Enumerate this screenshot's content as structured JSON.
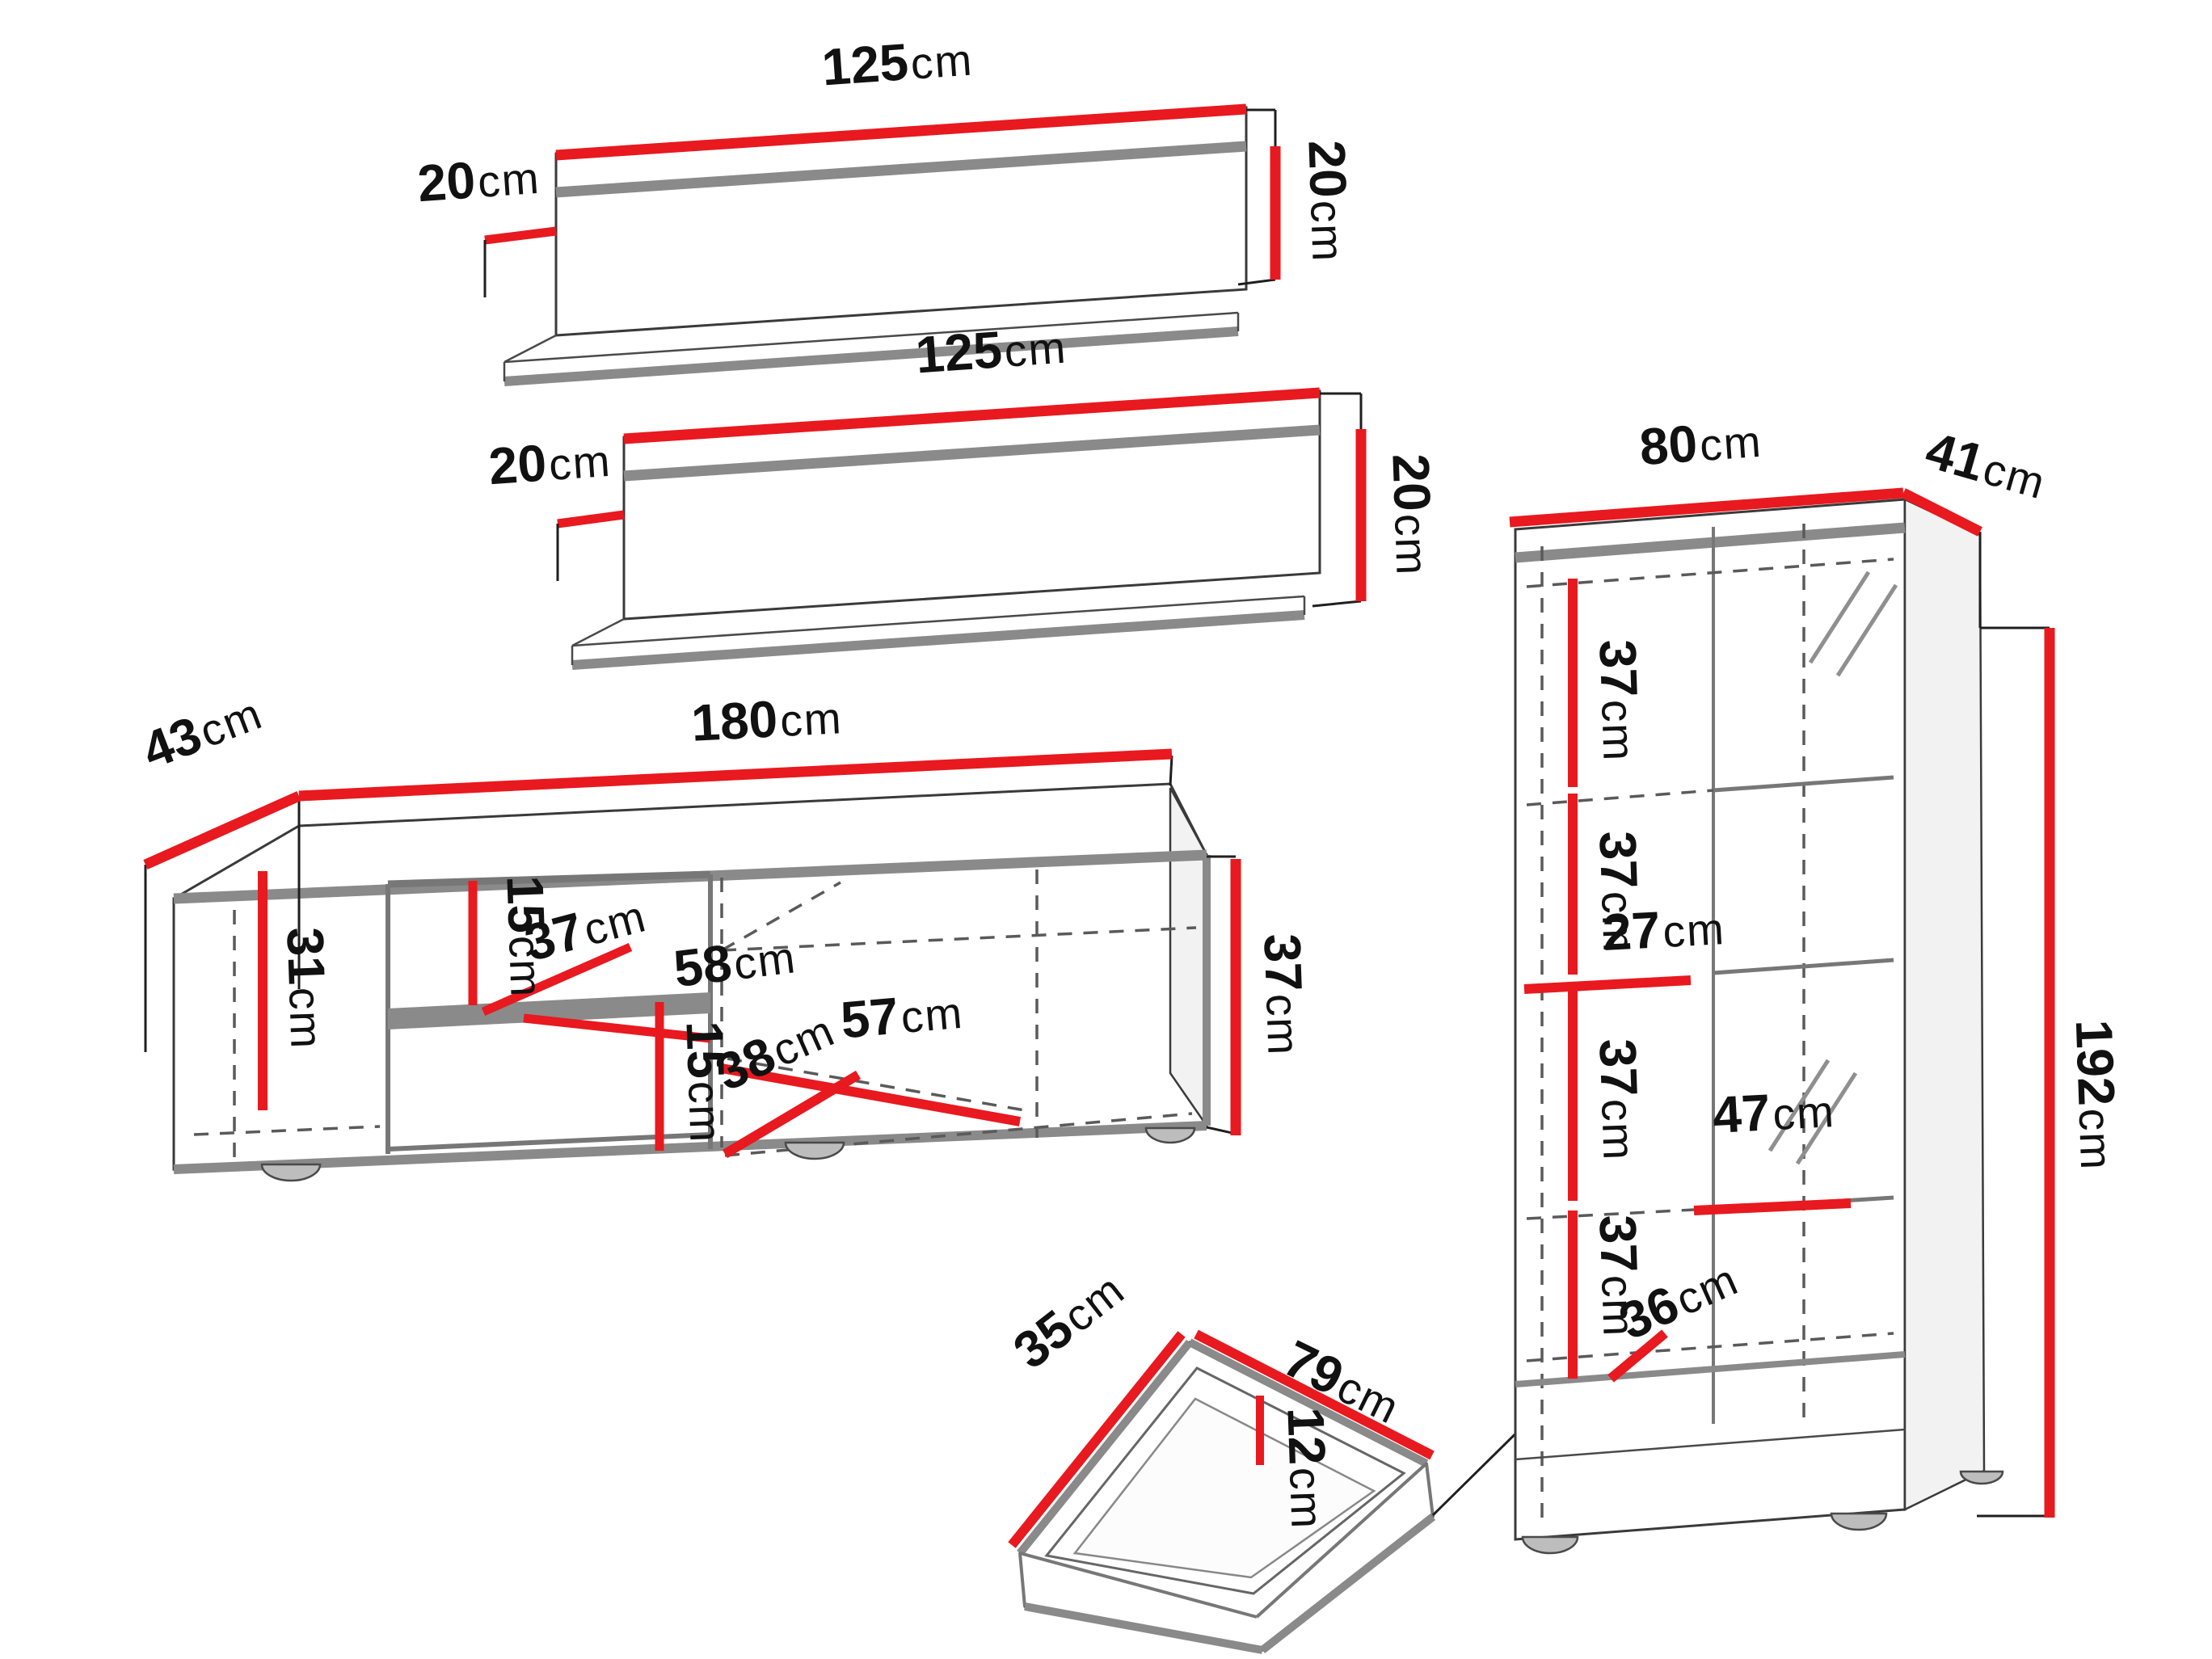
{
  "diagram": {
    "title": "Wall unit furniture set dimensions",
    "unit": "cm",
    "colors": {
      "dimension_red": "#e8191f",
      "outline_gray": "#8a8a8a",
      "line_black": "#1f1f1f"
    },
    "wall_shelf_1": {
      "width": {
        "num": "125",
        "unit": "cm"
      },
      "depth": {
        "num": "20",
        "unit": "cm"
      },
      "height": {
        "num": "20",
        "unit": "cm"
      }
    },
    "wall_shelf_2": {
      "width": {
        "num": "125",
        "unit": "cm"
      },
      "depth": {
        "num": "20",
        "unit": "cm"
      },
      "height": {
        "num": "20",
        "unit": "cm"
      }
    },
    "tv_stand": {
      "depth": {
        "num": "43",
        "unit": "cm"
      },
      "width": {
        "num": "180",
        "unit": "cm"
      },
      "left_inner_height": {
        "num": "31",
        "unit": "cm"
      },
      "upper_niche_height": {
        "num": "15",
        "unit": "cm"
      },
      "shelf_depth": {
        "num": "37",
        "unit": "cm"
      },
      "middle_width": {
        "num": "58",
        "unit": "cm"
      },
      "lower_niche_height": {
        "num": "15",
        "unit": "cm"
      },
      "bottom_depth": {
        "num": "38",
        "unit": "cm"
      },
      "right_inner_width": {
        "num": "57",
        "unit": "cm"
      },
      "height": {
        "num": "37",
        "unit": "cm"
      }
    },
    "drawer": {
      "depth": {
        "num": "35",
        "unit": "cm"
      },
      "width": {
        "num": "79",
        "unit": "cm"
      },
      "height": {
        "num": "12",
        "unit": "cm"
      }
    },
    "display_cabinet": {
      "width": {
        "num": "80",
        "unit": "cm"
      },
      "depth": {
        "num": "41",
        "unit": "cm"
      },
      "section_1_height": {
        "num": "37",
        "unit": "cm"
      },
      "section_2_height": {
        "num": "37",
        "unit": "cm"
      },
      "middle_inner_width": {
        "num": "27",
        "unit": "cm"
      },
      "section_3_height": {
        "num": "37",
        "unit": "cm"
      },
      "section_4_height": {
        "num": "37",
        "unit": "cm"
      },
      "shelf_inner_width": {
        "num": "47",
        "unit": "cm"
      },
      "bottom_inner_depth": {
        "num": "36",
        "unit": "cm"
      },
      "height": {
        "num": "192",
        "unit": "cm"
      }
    }
  }
}
